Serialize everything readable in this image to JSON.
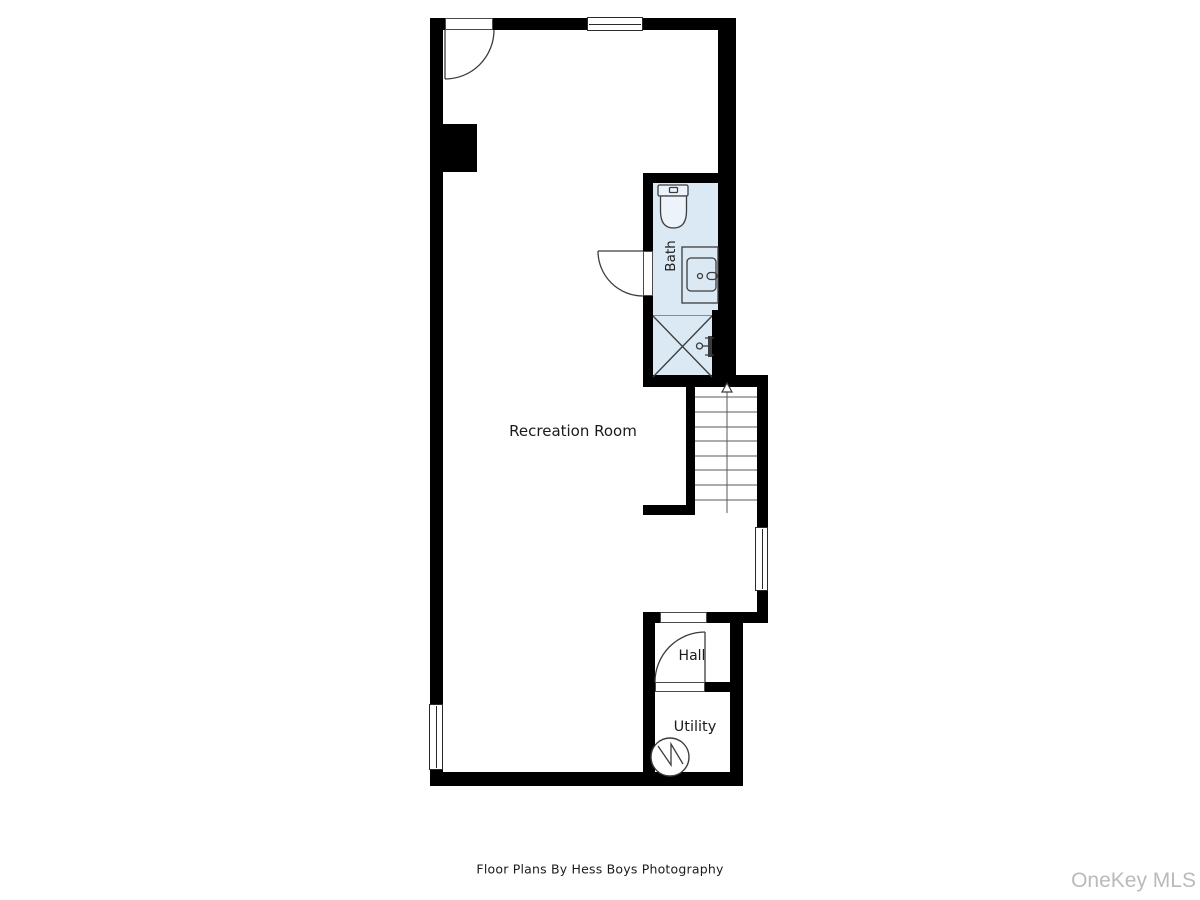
{
  "image": {
    "type": "floor-plan",
    "footer_credit": "Floor Plans By Hess Boys Photography",
    "watermark": "OneKey MLS"
  },
  "plan": {
    "rooms": [
      {
        "id": "recreation-room",
        "label": "Recreation Room"
      },
      {
        "id": "bath",
        "label": "Bath"
      },
      {
        "id": "hall",
        "label": "Hall"
      },
      {
        "id": "utility",
        "label": "Utility"
      }
    ],
    "fixtures": [
      {
        "name": "toilet",
        "room": "bath"
      },
      {
        "name": "sink-vanity",
        "room": "bath"
      },
      {
        "name": "crossed-box-shower",
        "room": "bath"
      },
      {
        "name": "valve-spigot",
        "room": "bath"
      },
      {
        "name": "staircase-up-arrow",
        "room": "stairwell"
      },
      {
        "name": "water-heater-circle-zigzag",
        "room": "utility"
      }
    ],
    "doors": [
      {
        "location": "top-wall-entry",
        "swing": "into-room-left-hinge"
      },
      {
        "location": "bath-left-wall",
        "swing": "out-into-recreation-room"
      },
      {
        "location": "hall-to-utility",
        "swing": "into-hall-right-hinge"
      }
    ],
    "windows": [
      {
        "location": "top-wall-center"
      },
      {
        "location": "right-wall-below-stairs"
      },
      {
        "location": "left-wall-bottom"
      }
    ],
    "colors": {
      "wall": "#000000",
      "bath_fill": "#dbe9f4",
      "line": "#3c3c3c",
      "text": "#1b1b1b",
      "watermark": "#b7bbbe",
      "background": "#ffffff"
    }
  }
}
